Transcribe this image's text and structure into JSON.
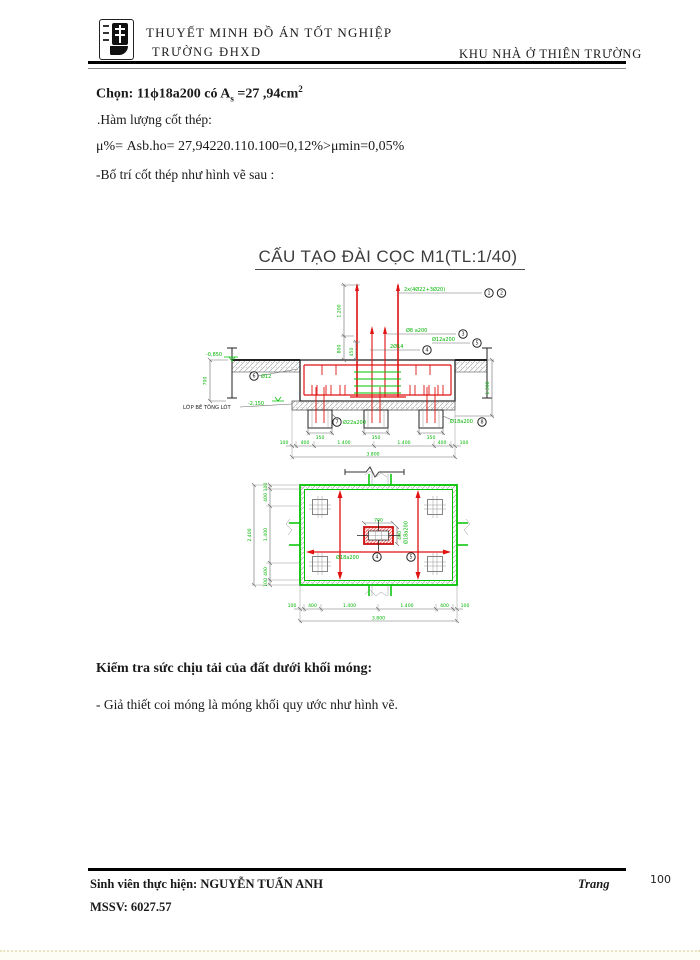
{
  "header": {
    "title_line1": "THUYẾT MINH ĐỒ ÁN TỐT NGHIỆP",
    "title_line2": "TRƯỜNG ĐHXD",
    "project": "KHU NHÀ Ở THIÊN TRƯỜNG"
  },
  "intro": {
    "line1_main": "Chọn:  11ϕ18a200 có A",
    "line1_sub": "s",
    "line1_mid": " =27 ,94cm",
    "line1_sup": "2",
    "line2": ".Hàm lượng cốt thép:",
    "line3": "μ%=  Asb.ho=  27,94220.110.100=0,12%>μmin=0,05%",
    "line4": "-Bố trí cốt thép như hình vẽ sau :"
  },
  "drawing": {
    "title": "CẤU TẠO ĐÀI CỌC M1(TL:1/40)",
    "bubbles": [
      "1",
      "2",
      "3",
      "4",
      "5",
      "6",
      "7",
      "8"
    ],
    "section": {
      "callout_main": "2x(4Ø22+3Ø20)",
      "callout_stirrups": "Ø8 a200",
      "callout_2d14": "2Ø14",
      "callout_d12a200": "Ø12a200",
      "callout_d12": "Ø12",
      "callout_d22a200": "Ø22a200",
      "callout_d18a200": "Ø18a200",
      "level_top": "-0,850",
      "level_bottom": "-2,150",
      "label_lot": "LỚP BÊ TÔNG LÓT",
      "dim_col": "1.200",
      "dim_col2": "800",
      "dim_col3": "450",
      "dim_depth": "700",
      "dim_right": "1.300",
      "pile_dims": [
        "350",
        "350",
        "350"
      ],
      "dims_bottom": [
        "100",
        "400",
        "1.400",
        "1.400",
        "400",
        "100"
      ],
      "dim_total": "3.800"
    },
    "plan": {
      "dims_left": [
        "100",
        "400",
        "1.400",
        "400",
        "100"
      ],
      "dim_left_total": "2.400",
      "dims_bottom": [
        "100",
        "400",
        "1.400",
        "1.400",
        "400",
        "100"
      ],
      "dim_bottom_total": "3.800",
      "col_dim_w": "700",
      "col_dim_h": "400",
      "callout_left": "Ø18a200",
      "callout_right": "Ø18a200",
      "callout_rot": "Ø18a200"
    }
  },
  "check": {
    "heading": "Kiểm tra sức chịu tải của đất dưới khối móng:",
    "line": "- Giả thiết coi móng là móng khối quy ước như hình vẽ."
  },
  "footer": {
    "student_label": "Sinh viên thực hiện:",
    "student_name": " NGUYỄN TUẤN ANH",
    "mssv": "MSSV: 6027.57",
    "page_label": "Trang",
    "page_number": "100"
  }
}
